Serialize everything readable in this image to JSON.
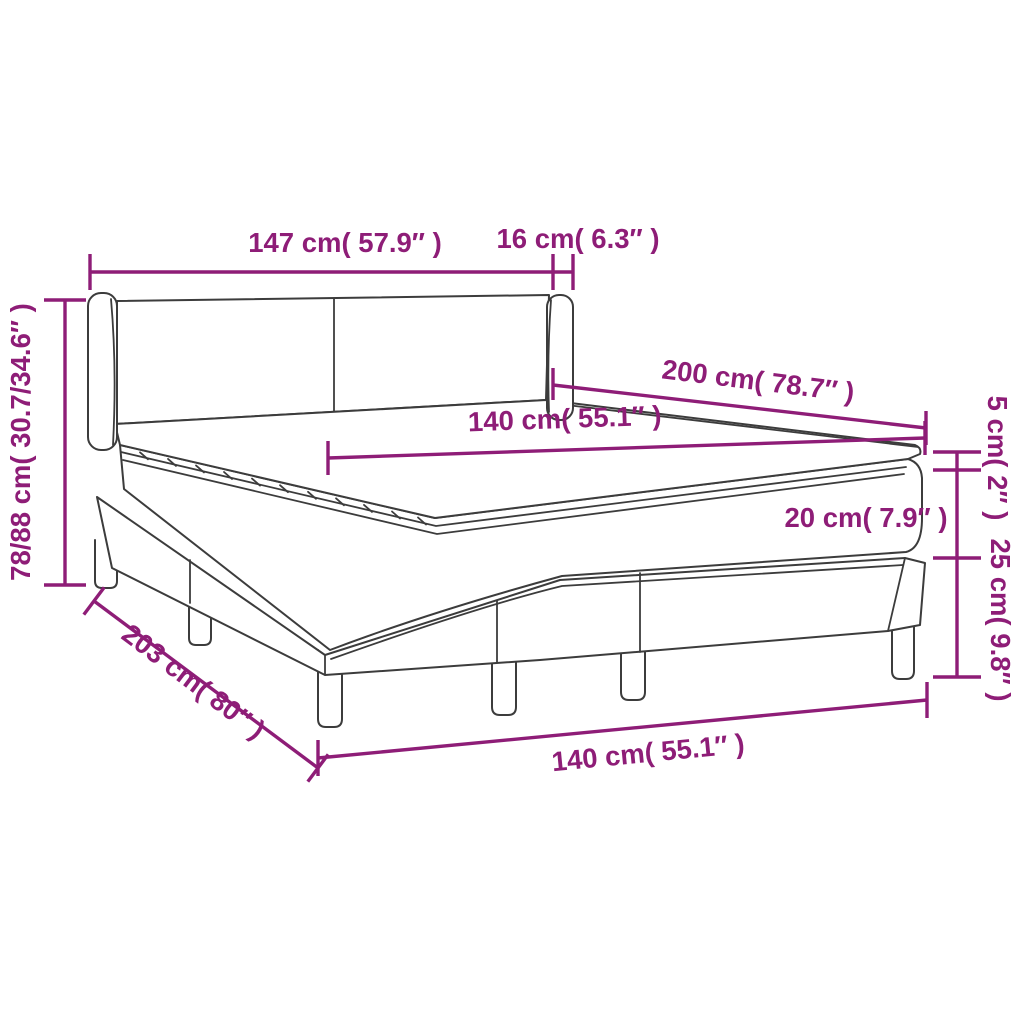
{
  "diagram": {
    "title": "box-spring-bed-dimension-diagram",
    "labels": {
      "headboard_width": "147 cm( 57.9″ )",
      "wing_depth": "16 cm( 6.3″ )",
      "total_height": "78/88 cm( 30.7/34.6″ )",
      "bed_length": "200 cm( 78.7″ )",
      "mattress_width": "140 cm( 55.1″ )",
      "topper_height": "5 cm( 2″ )",
      "mattress_height": "20 cm( 7.9″ )",
      "base_height": "25 cm( 9.8″ )",
      "base_length": "203 cm( 80″ )",
      "base_width": "140 cm( 55.1″ )"
    },
    "colors": {
      "dimension": "#8E1D77",
      "outline": "#3C3C3C",
      "background": "#FFFFFF"
    }
  }
}
